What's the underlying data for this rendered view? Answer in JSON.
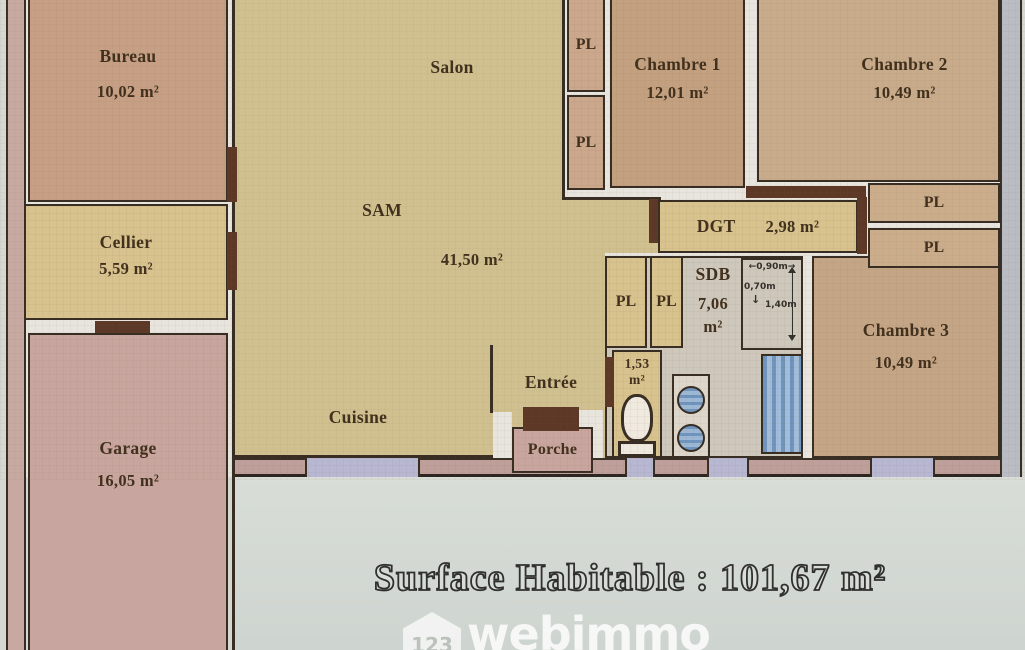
{
  "rooms": {
    "bureau": {
      "name": "Bureau",
      "area": "10,02 m²"
    },
    "cellier": {
      "name": "Cellier",
      "area": "5,59 m²"
    },
    "garage": {
      "name": "Garage",
      "area": "16,05 m²"
    },
    "salon": {
      "name": "Salon"
    },
    "sam": {
      "name": "SAM",
      "area": "41,50 m²"
    },
    "cuisine": {
      "name": "Cuisine"
    },
    "entree": {
      "name": "Entrée"
    },
    "porche": {
      "name": "Porche"
    },
    "chambre1": {
      "name": "Chambre 1",
      "area": "12,01 m²"
    },
    "chambre2": {
      "name": "Chambre 2",
      "area": "10,49 m²"
    },
    "chambre3": {
      "name": "Chambre 3",
      "area": "10,49 m²"
    },
    "dgt": {
      "name": "DGT",
      "area": "2,98 m²"
    },
    "sdb": {
      "name": "SDB",
      "area": "7,06",
      "unit": "m²"
    },
    "wc": {
      "area": "1,53",
      "unit": "m²"
    }
  },
  "closet_label": "PL",
  "dimensions": {
    "width_top": "0,90m",
    "depth_left": "0,70m",
    "height_right": "1,40m"
  },
  "footer": {
    "surface_text": "Surface Habitable : 101,67 m²"
  },
  "watermark": {
    "prefix": "123",
    "brand": "webimmo"
  },
  "palette": {
    "living_tan": "#d1c08f",
    "bedroom_brown": "#c3a07f",
    "service_yellow": "#d8c28d",
    "garage_pink": "#c8a59e",
    "bath_floor": "#cec7bb",
    "fixture_blue": "#7ca2c6",
    "window_lavender": "#b8b7d2",
    "wall_line": "#372d22",
    "door_brown": "#5d3827",
    "paper": "#d4d8d1"
  }
}
